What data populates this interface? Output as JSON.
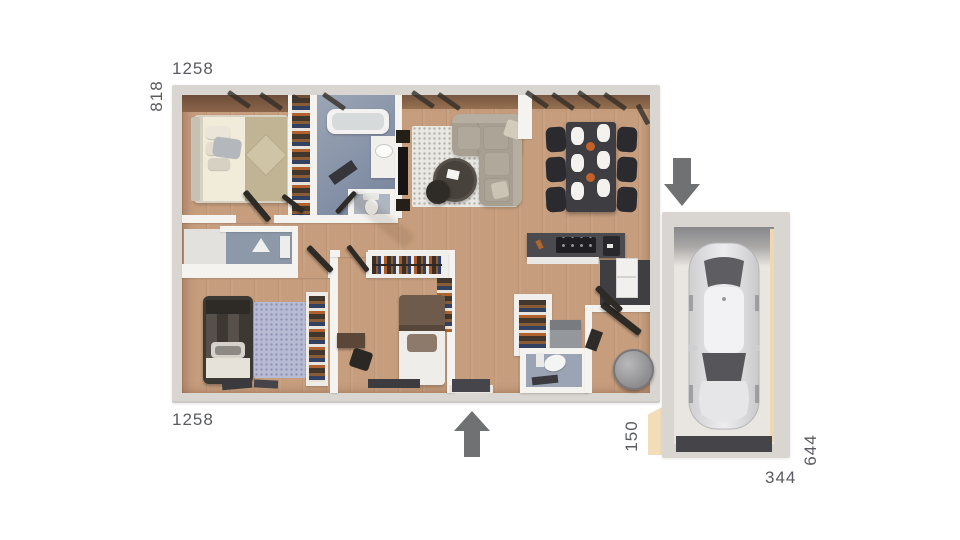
{
  "plan": {
    "dimensions": {
      "house_width_top": "1258",
      "house_depth_left": "818",
      "house_width_bottom": "1258",
      "passage_depth": "150",
      "garage_depth_right": "644",
      "garage_width_bottom": "344"
    },
    "icons": {
      "garage_entrance": "arrow-down-icon",
      "main_entrance": "arrow-up-icon"
    },
    "colors": {
      "background": "#ffffff",
      "label_text": "#5a5b5e",
      "arrow": "#6f7173",
      "exterior_wall": "#d9d5d0",
      "interior_wall": "#f4f3f0",
      "wood_floor": "#c69e7e",
      "bathroom_floor": "#8a97ab",
      "kitchen_counter": "#4a4a4f",
      "dining_table": "#3d3d42",
      "sofa": "#a79f92",
      "living_rug": "#eae8e3",
      "bedroom_rug": "#b7bbd3",
      "garage_floor": "#e9e5e0",
      "garage_door": "#454549",
      "wall_cut_section": "#f3ddb8",
      "car_body": "#e9e9eb"
    }
  }
}
